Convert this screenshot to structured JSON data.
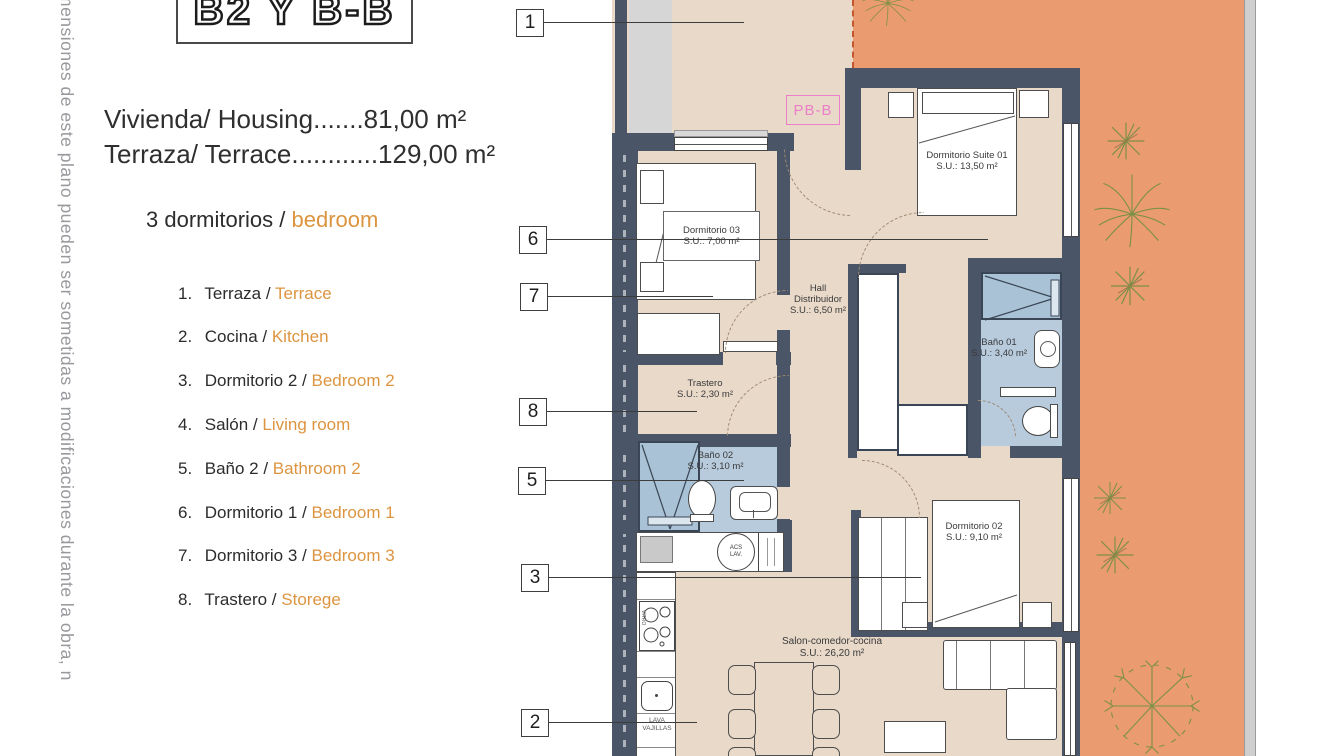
{
  "side_note": {
    "text": "mensiones de este plano pueden ser sometidas a modificaciones durante la obra, n"
  },
  "title_block": {
    "code": "B2 Y B-B"
  },
  "summary": {
    "line1": "Vivienda/ Housing.......81,00 m²",
    "line2": "Terraza/ Terrace............129,00 m²",
    "bedrooms_black": "3 dormitorios /",
    "bedrooms_orange": "bedroom"
  },
  "legend": {
    "items": [
      {
        "num": "1.",
        "es": "Terraza /",
        "en": "Terrace"
      },
      {
        "num": "2.",
        "es": "Cocina /",
        "en": "Kitchen"
      },
      {
        "num": "3.",
        "es": "Dormitorio 2 /",
        "en": "Bedroom 2"
      },
      {
        "num": "4.",
        "es": "Salón /",
        "en": "Living room"
      },
      {
        "num": "5.",
        "es": "Baño 2 /",
        "en": "Bathroom 2"
      },
      {
        "num": "6.",
        "es": "Dormitorio 1 /",
        "en": "Bedroom 1"
      },
      {
        "num": "7.",
        "es": "Dormitorio 3 /",
        "en": "Bedroom 3"
      },
      {
        "num": "8.",
        "es": "Trastero /",
        "en": "Storege"
      }
    ]
  },
  "plan": {
    "plan_code": "PB-B",
    "markers": [
      "1",
      "6",
      "7",
      "8",
      "5",
      "3",
      "2"
    ],
    "rooms": {
      "suite": {
        "name": "Dormitorio Suite 01",
        "area": "S.U.: 13,50 m²"
      },
      "dorm03": {
        "name": "Dormitorio 03",
        "area": "S.U.: 7,00 m²"
      },
      "hall": {
        "l1": "Hall",
        "l2": "Distribuidor",
        "area": "S.U.: 6,50 m²"
      },
      "trastero": {
        "name": "Trastero",
        "area": "S.U.: 2,30 m²"
      },
      "bano01": {
        "name": "Baño 01",
        "area": "S.U.: 3,40 m²"
      },
      "bano02": {
        "name": "Baño 02",
        "area": "S.U.: 3,10 m²"
      },
      "dorm02": {
        "name": "Dormitorio 02",
        "area": "S.U.: 9,10 m²"
      },
      "salon": {
        "name": "Salon-comedor-cocina",
        "area": "S.U.: 26,20 m²"
      }
    },
    "labels": {
      "acs": "ACS LAV.",
      "lavavajillas_1": "LAVA",
      "lavavajillas_2": "VAJILLAS",
      "vitro": "VITRO"
    }
  },
  "colors": {
    "terrace_orange": "#ea9c70",
    "floor_beige": "#e8d9c9",
    "wall_dark": "#4a5568",
    "bath_blue": "#b7cbdd",
    "legend_orange": "#dd9440",
    "plan_code_pink": "#ec7fc8",
    "note_gray": "#98999d"
  }
}
